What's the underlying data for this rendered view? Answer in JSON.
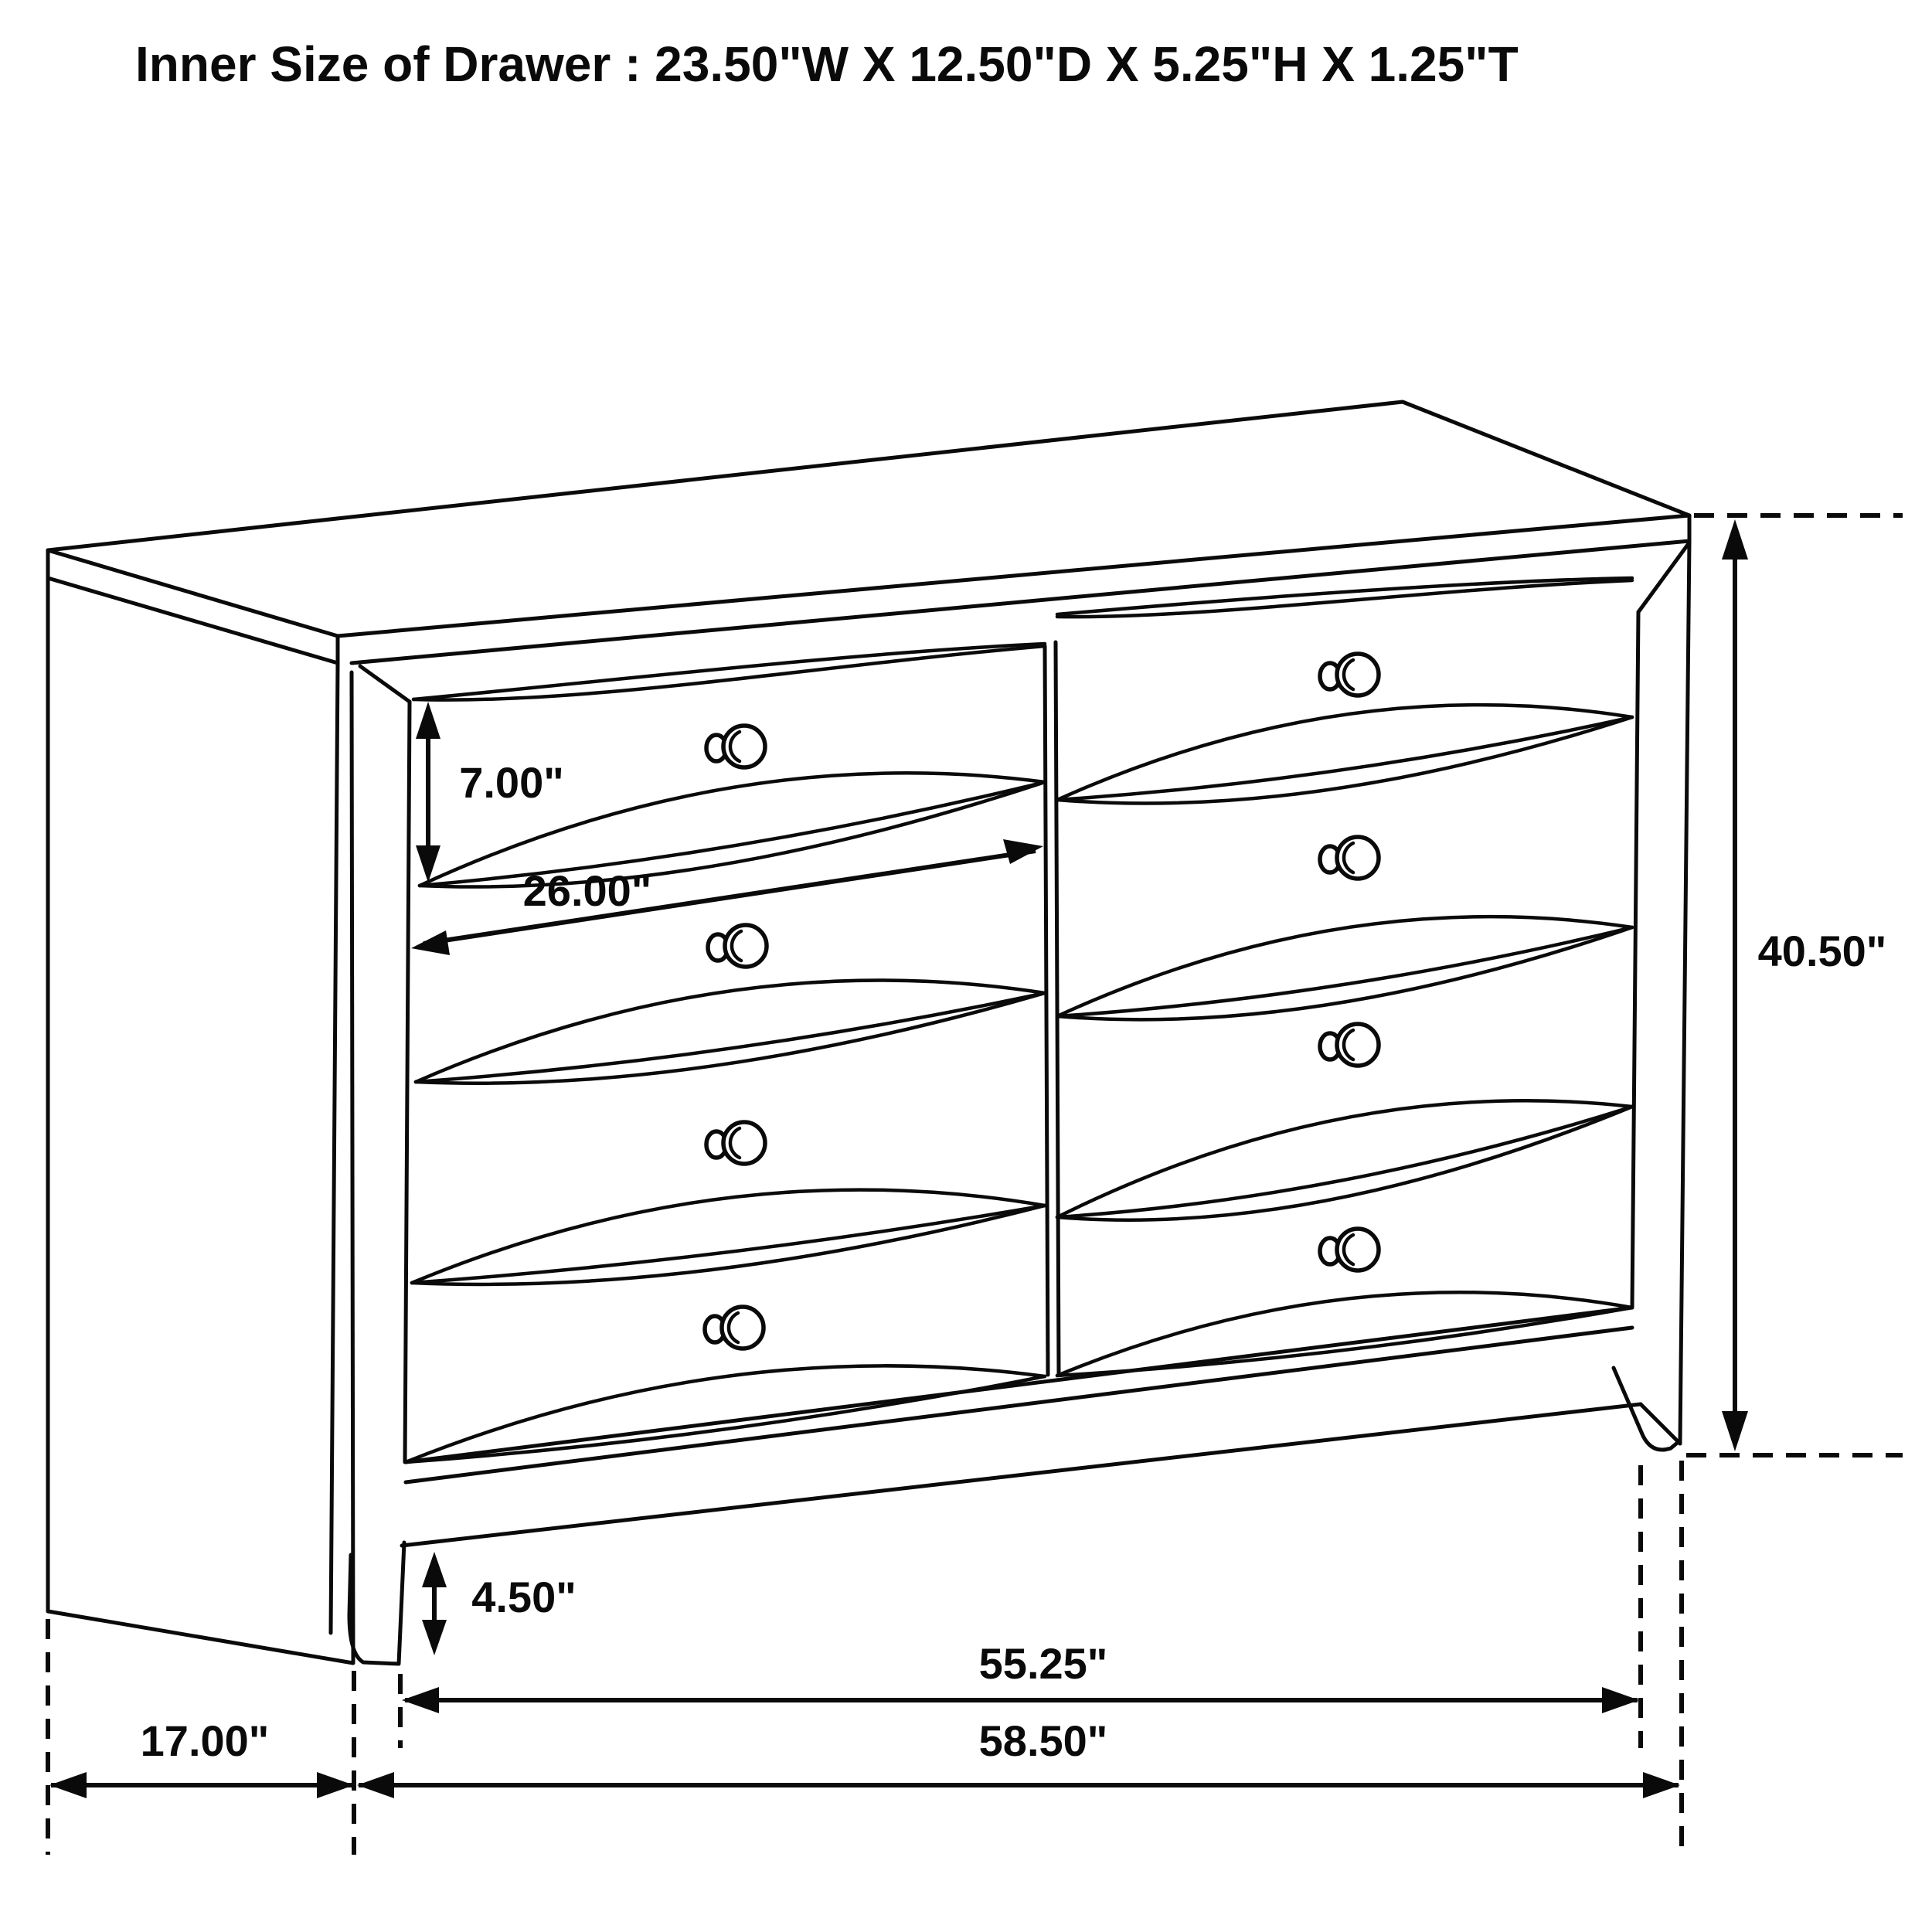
{
  "title": "Inner Size of Drawer : 23.50\"W X 12.50\"D X 5.25\"H X 1.25\"T",
  "diagram": {
    "type": "furniture-dimension-line-drawing",
    "subject": "eight-drawer dresser shown in three-quarter perspective",
    "line_color": "#0a0a0a",
    "background_color": "#ffffff",
    "knob_count": 8
  },
  "labels": {
    "drawer_height": "7.00\"",
    "drawer_width": "26.00\"",
    "overall_height": "40.50\"",
    "foot_height": "4.50\"",
    "base_width": "55.25\"",
    "depth": "17.00\"",
    "overall_width": "58.50\""
  }
}
